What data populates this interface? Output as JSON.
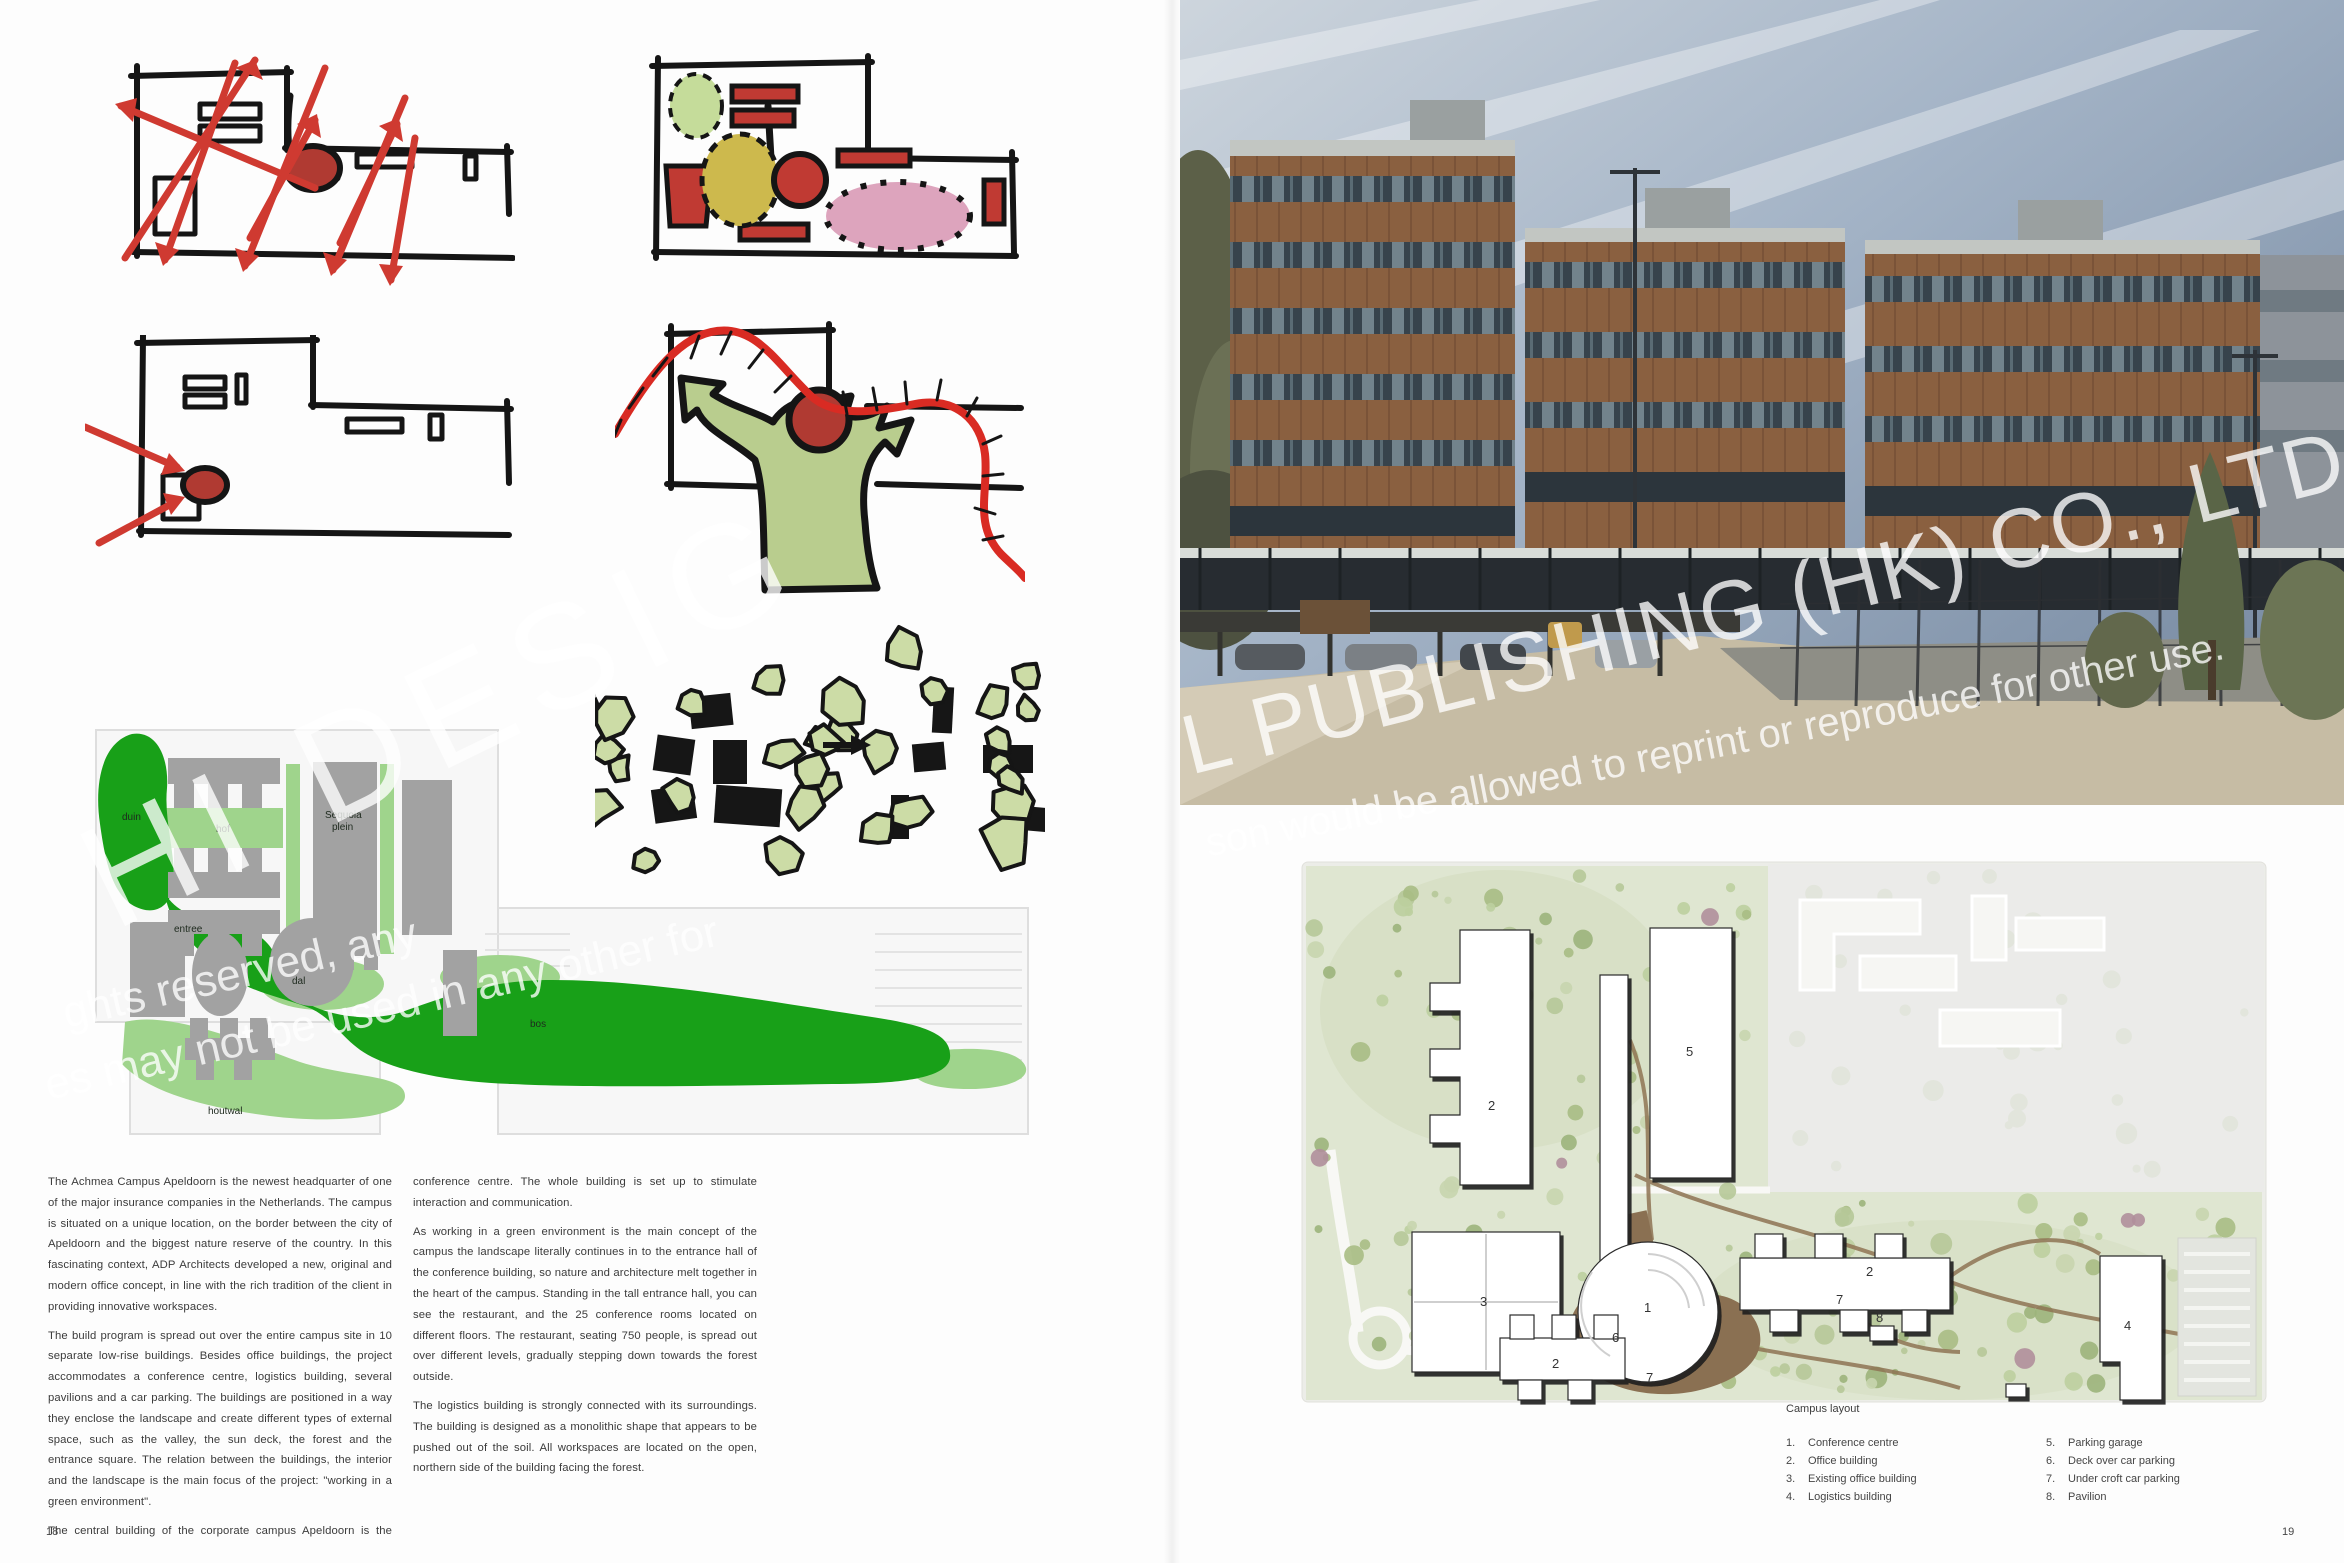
{
  "pages": {
    "left_number": "18",
    "right_number": "19"
  },
  "watermarks": {
    "left_big": "HI DESIG",
    "left_line1": "ghts reserved, any",
    "left_line2": "es may not be used in any other for",
    "right_big": "L PUBLISHING (HK) CO., LTD.",
    "right_small": "son would be allowed to reprint or reproduce for other use."
  },
  "article": {
    "col1": [
      "The Achmea Campus Apeldoorn is the newest headquarter of one of the major insurance companies in the Netherlands. The campus is situated on a unique location, on the border between the city of Apeldoorn and the biggest nature reserve of the country. In this fascinating context, ADP Architects developed a new, original and modern office concept, in line with the rich tradition of the client in providing innovative workspaces.",
      "The build program is spread out over the entire campus site in 10 separate low-rise buildings. Besides office buildings, the project accommodates a conference centre, logistics building, several pavilions and a car parking. The buildings are positioned in a way they enclose the landscape and create different types of external space, such as the valley, the sun deck, the forest and the entrance square. The relation between the buildings, the interior and the landscape is the main focus of the project: \"working in a green environment\".",
      "The central building of the corporate campus Apeldoorn is the"
    ],
    "col2": [
      "conference centre. The whole building is set up to stimulate interaction and communication.",
      "As working in a green environment is the main concept of the campus the landscape literally continues in to the entrance hall of the conference building, so nature and architecture melt together in the heart of the campus. Standing in the tall entrance hall, you can see  the restaurant, and the 25 conference rooms located on different floors. The restaurant, seating 750 people,  is spread out over different levels, gradually stepping down towards the forest outside.",
      "The logistics building is strongly connected with its surroundings. The building is designed as a monolithic shape that appears to be pushed out of the soil. All workspaces are located on the open, northern side of the building facing the forest."
    ]
  },
  "left_plan": {
    "labels": {
      "duin": "duin",
      "hof": "hof",
      "sequoia_1": "Sequoia",
      "sequoia_2": "plein",
      "entree": "entree",
      "dal": "dal",
      "bos": "bos",
      "houtwal": "houtwal"
    },
    "colors": {
      "dark_green": "#18a018",
      "light_green": "#9fd48c",
      "building_gray": "#a2a2a2"
    }
  },
  "right_plan": {
    "numbers": {
      "n1": "1",
      "n2": "2",
      "n3": "3",
      "n4": "4",
      "n5": "5",
      "n6": "6",
      "n7": "7",
      "n8": "8"
    },
    "colors": {
      "field_green": "#dfe6d1",
      "path_brown": "#8f7454",
      "deck_brown": "#8a7052"
    }
  },
  "sketch_colors": {
    "red": "#c9382f",
    "green": "#b9cd8e",
    "olive": "#cdb94d",
    "pink": "#dda4bd",
    "tree_green": "#ccdca6"
  },
  "campus_layout": {
    "title": "Campus layout",
    "items_left": [
      {
        "num": "1.",
        "label": "Conference centre"
      },
      {
        "num": "2.",
        "label": "Office building"
      },
      {
        "num": "3.",
        "label": "Existing office building"
      },
      {
        "num": "4.",
        "label": "Logistics building"
      }
    ],
    "items_right": [
      {
        "num": "5.",
        "label": "Parking garage"
      },
      {
        "num": "6.",
        "label": "Deck over car parking"
      },
      {
        "num": "7.",
        "label": "Under croft car parking"
      },
      {
        "num": "8.",
        "label": "Pavilion"
      }
    ]
  }
}
